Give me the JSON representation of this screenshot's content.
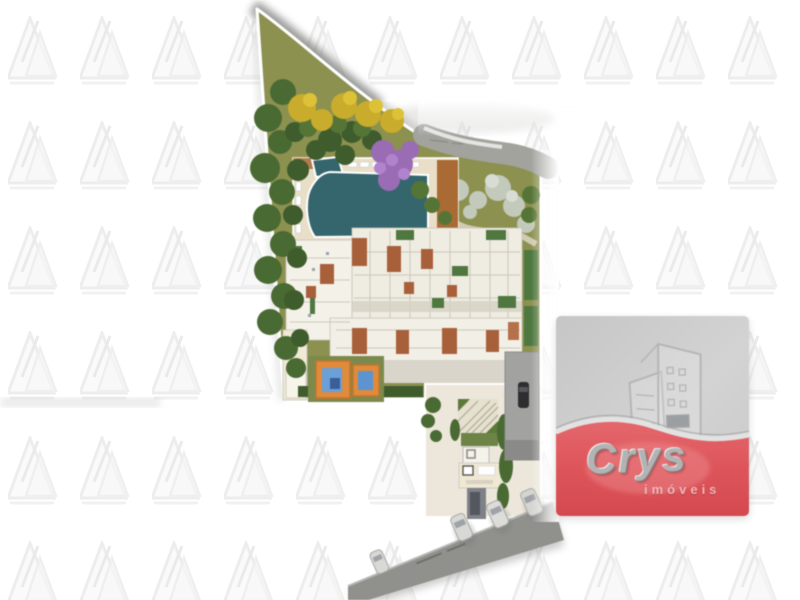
{
  "image": {
    "kind": "real-estate-listing-graphic",
    "subject": "condominium-site-plan-aerial"
  },
  "brand_logo": {
    "name": "Crys",
    "tagline": "imóveis",
    "mark_icon": "buildings-outline-icon"
  },
  "watermark": {
    "icon": "double-triangle-logo-icon",
    "columns": 11,
    "rows": 6,
    "tile_w": 72,
    "tile_h": 105
  },
  "colors": {
    "lawn": "#8c9150",
    "road": "#a3a39e",
    "street": "#90908c",
    "pool": "#35656d",
    "deck": "#a96a33",
    "roof": "#a8603a",
    "hedge": "#3f5c2d",
    "tree_green": "#4a6a33",
    "tree_yellow": "#c9ac2b",
    "tree_purple": "#9a6cb4",
    "tree_gray": "#c3c9bb",
    "playground_orange": "#e08a3c",
    "playground_blue": "#6aa0d8",
    "logo_red": "#dd555a",
    "logo_panel": "#cbcbcb",
    "watermark": "#eeeeee"
  },
  "site_plan_features": [
    "perimeter-road",
    "lawn",
    "swimming-pool",
    "kids-pool",
    "wood-deck",
    "loungers",
    "main-building",
    "playground",
    "gardens",
    "pergola",
    "entrance-lobby",
    "car-ramp",
    "street",
    "parked-cars",
    "trees-green",
    "trees-yellow",
    "trees-purple",
    "trees-gray"
  ]
}
